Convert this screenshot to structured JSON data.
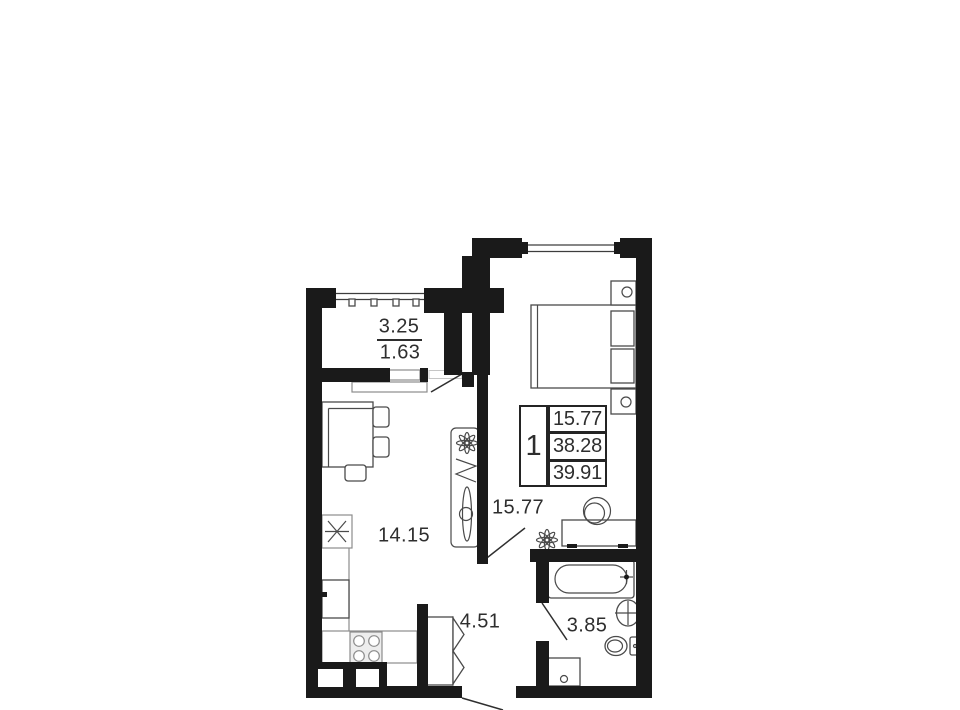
{
  "legend": {
    "rooms_count": "1",
    "living_area": "15.77",
    "area_without_balcony": "38.28",
    "total_area": "39.91"
  },
  "rooms": {
    "balcony": {
      "area_full": "3.25",
      "area_reduced": "1.63"
    },
    "kitchen": {
      "area": "14.15"
    },
    "living_room": {
      "area": "15.77"
    },
    "hallway": {
      "area": "4.51"
    },
    "bathroom": {
      "area": "3.85"
    }
  },
  "colors": {
    "wall": "#1a1a1a",
    "line": "#3d3d3d",
    "text": "#2e2e2e",
    "background": "#ffffff"
  },
  "icons": [
    "bed",
    "nightstand",
    "desk",
    "desk-chair",
    "plant-flower",
    "dining-table",
    "chair",
    "kitchen-sink",
    "refrigerator",
    "stove",
    "counter",
    "wardrobe",
    "cabinet",
    "ironing-board",
    "bathtub",
    "washbasin",
    "toilet",
    "washing-machine",
    "window",
    "door-leaf",
    "vent-shaft"
  ]
}
